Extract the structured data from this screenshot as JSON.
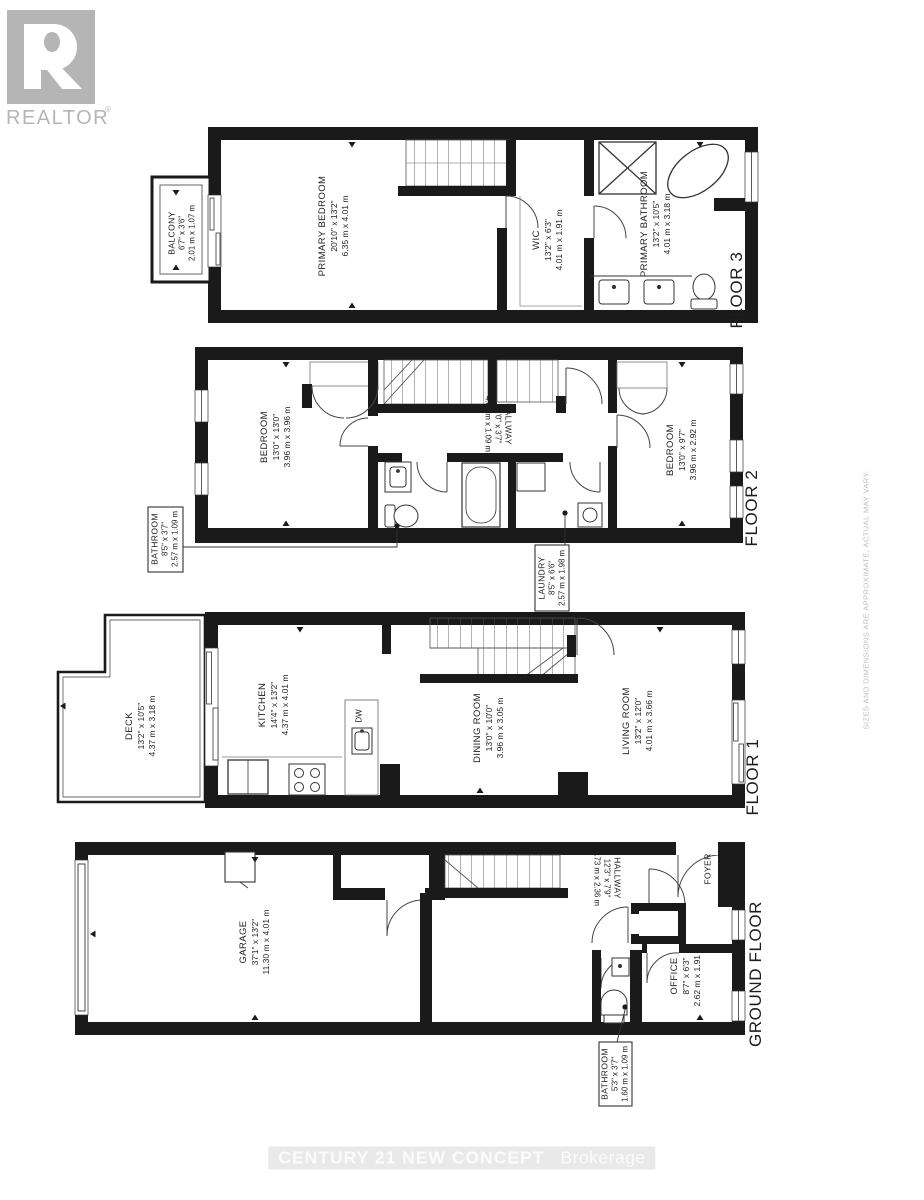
{
  "branding": {
    "logo_word": "REALTOR",
    "registered_mark": "®",
    "footer_brand": "CENTURY 21 NEW CONCEPT",
    "footer_suffix": "Brokerage",
    "disclaimer": "SIZES AND DIMENSIONS ARE APPROXIMATE, ACTUAL MAY VARY."
  },
  "floors": [
    {
      "label": "FLOOR 3",
      "rooms": [
        {
          "name": "BALCONY",
          "imperial": "6'7\" x 3'6\"",
          "metric": "2.01 m x 1.07 m"
        },
        {
          "name": "PRIMARY BEDROOM",
          "imperial": "20'10\" x 13'2\"",
          "metric": "6.35 m x 4.01 m"
        },
        {
          "name": "WIC",
          "imperial": "13'2\" x 6'3\"",
          "metric": "4.01 m x 1.91 m"
        },
        {
          "name": "PRIMARY BATHROOM",
          "imperial": "13'2\" x 10'5\"",
          "metric": "4.01 m x 3.18 m"
        }
      ]
    },
    {
      "label": "FLOOR 2",
      "rooms": [
        {
          "name": "BEDROOM",
          "imperial": "13'0\" x 13'0\"",
          "metric": "3.96 m x 3.96 m"
        },
        {
          "name": "HALLWAY",
          "imperial": "16'0\" x 3'7\"",
          "metric": "4.88 m x 1.09 m"
        },
        {
          "name": "BEDROOM",
          "imperial": "13'0\" x 9'7\"",
          "metric": "3.96 m x 2.92 m"
        },
        {
          "name": "BATHROOM",
          "imperial": "8'5\" x 3'7\"",
          "metric": "2.57 m x 1.09 m"
        },
        {
          "name": "LAUNDRY",
          "imperial": "8'5\" x 6'6\"",
          "metric": "2.57 m x 1.98 m"
        }
      ]
    },
    {
      "label": "FLOOR 1",
      "rooms": [
        {
          "name": "DECK",
          "imperial": "13'2\" x 10'5\"",
          "metric": "4.37 m x 3.18 m"
        },
        {
          "name": "KITCHEN",
          "imperial": "14'4\" x 13'2\"",
          "metric": "4.37 m x 4.01 m"
        },
        {
          "name": "DW"
        },
        {
          "name": "DINING ROOM",
          "imperial": "13'0\" x 10'0\"",
          "metric": "3.96 m x 3.05 m"
        },
        {
          "name": "LIVING ROOM",
          "imperial": "13'2\" x 12'0\"",
          "metric": "4.01 m x 3.66 m"
        }
      ]
    },
    {
      "label": "GROUND FLOOR",
      "rooms": [
        {
          "name": "GARAGE",
          "imperial": "37'1\" x 13'2\"",
          "metric": "11.30 m x 4.01 m"
        },
        {
          "name": "HALLWAY",
          "imperial": "12'3\" x 7'9\"",
          "metric": "3.73 m x 2.36 m"
        },
        {
          "name": "FOYER"
        },
        {
          "name": "OFFICE",
          "imperial": "8'7\" x 6'3\"",
          "metric": "2.62 m x 1.91 m"
        },
        {
          "name": "BATHROOM",
          "imperial": "5'3\" x 3'7\"",
          "metric": "1.60 m x 1.09 m"
        }
      ]
    }
  ]
}
